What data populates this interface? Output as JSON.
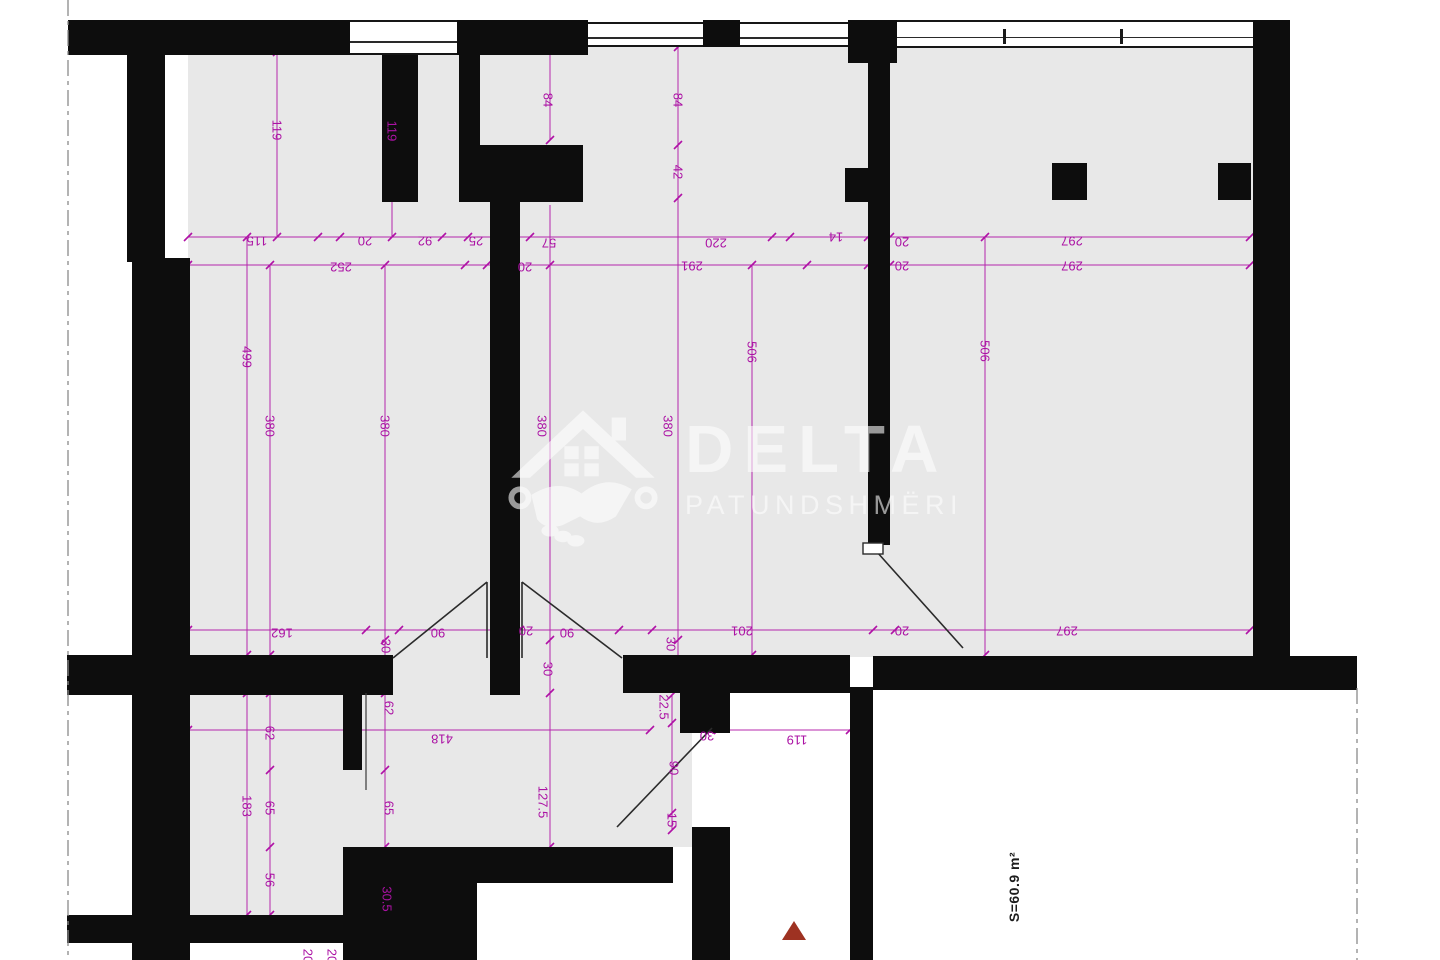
{
  "plan": {
    "watermark": {
      "brand": "DELTA",
      "subtitle": "PATUNDSHMËRI"
    },
    "area_label": "S=60.9 m²",
    "colors": {
      "dimension": "#ab12a4",
      "wall": "#0d0d0d",
      "floor": "#e8e8e8",
      "marker": "#9e3222",
      "boundary": "#8a8a8a"
    },
    "dimensions": [
      {
        "text": "115",
        "x": 257,
        "y": 241,
        "rot": 180
      },
      {
        "text": "20",
        "x": 365,
        "y": 241,
        "rot": 180
      },
      {
        "text": "92",
        "x": 425,
        "y": 241,
        "rot": 180
      },
      {
        "text": "25",
        "x": 476,
        "y": 241,
        "rot": 180
      },
      {
        "text": "57",
        "x": 549,
        "y": 243,
        "rot": 180
      },
      {
        "text": "220",
        "x": 716,
        "y": 243,
        "rot": 180
      },
      {
        "text": "14",
        "x": 836,
        "y": 237,
        "rot": 180
      },
      {
        "text": "20",
        "x": 902,
        "y": 242,
        "rot": 180
      },
      {
        "text": "297",
        "x": 1072,
        "y": 241,
        "rot": 180
      },
      {
        "text": "252",
        "x": 341,
        "y": 267,
        "rot": 180
      },
      {
        "text": "20",
        "x": 525,
        "y": 267,
        "rot": 180
      },
      {
        "text": "291",
        "x": 692,
        "y": 266,
        "rot": 180
      },
      {
        "text": "20",
        "x": 902,
        "y": 266,
        "rot": 180
      },
      {
        "text": "297",
        "x": 1072,
        "y": 266,
        "rot": 180
      },
      {
        "text": "119",
        "x": 277,
        "y": 130,
        "rot": 90
      },
      {
        "text": "119",
        "x": 392,
        "y": 131,
        "rot": 90
      },
      {
        "text": "84",
        "x": 548,
        "y": 100,
        "rot": 90
      },
      {
        "text": "84",
        "x": 678,
        "y": 100,
        "rot": 90
      },
      {
        "text": "42",
        "x": 678,
        "y": 172,
        "rot": 90
      },
      {
        "text": "499",
        "x": 247,
        "y": 357,
        "rot": 90
      },
      {
        "text": "380",
        "x": 270,
        "y": 426,
        "rot": 90
      },
      {
        "text": "380",
        "x": 385,
        "y": 426,
        "rot": 90
      },
      {
        "text": "380",
        "x": 542,
        "y": 426,
        "rot": 90
      },
      {
        "text": "380",
        "x": 668,
        "y": 426,
        "rot": 90
      },
      {
        "text": "506",
        "x": 752,
        "y": 352,
        "rot": 90
      },
      {
        "text": "506",
        "x": 985,
        "y": 351,
        "rot": 90
      },
      {
        "text": "162",
        "x": 282,
        "y": 633,
        "rot": 180
      },
      {
        "text": "30",
        "x": 386,
        "y": 646,
        "rot": 90
      },
      {
        "text": "90",
        "x": 438,
        "y": 633,
        "rot": 180
      },
      {
        "text": "20",
        "x": 526,
        "y": 631,
        "rot": 180
      },
      {
        "text": "90",
        "x": 567,
        "y": 633,
        "rot": 180
      },
      {
        "text": "30",
        "x": 548,
        "y": 669,
        "rot": 90
      },
      {
        "text": "30",
        "x": 671,
        "y": 644,
        "rot": 90
      },
      {
        "text": "201",
        "x": 742,
        "y": 631,
        "rot": 180
      },
      {
        "text": "20",
        "x": 902,
        "y": 631,
        "rot": 180
      },
      {
        "text": "297",
        "x": 1067,
        "y": 631,
        "rot": 180
      },
      {
        "text": "418",
        "x": 442,
        "y": 739,
        "rot": 180
      },
      {
        "text": "30",
        "x": 707,
        "y": 736,
        "rot": 180
      },
      {
        "text": "119",
        "x": 797,
        "y": 740,
        "rot": 180
      },
      {
        "text": "22.5",
        "x": 664,
        "y": 707,
        "rot": 90
      },
      {
        "text": "90",
        "x": 674,
        "y": 768,
        "rot": 90
      },
      {
        "text": "15",
        "x": 672,
        "y": 820,
        "rot": 90
      },
      {
        "text": "62",
        "x": 270,
        "y": 733,
        "rot": 90
      },
      {
        "text": "62",
        "x": 389,
        "y": 708,
        "rot": 90
      },
      {
        "text": "183",
        "x": 247,
        "y": 806,
        "rot": 90
      },
      {
        "text": "65",
        "x": 270,
        "y": 808,
        "rot": 90
      },
      {
        "text": "65",
        "x": 389,
        "y": 808,
        "rot": 90
      },
      {
        "text": "127.5",
        "x": 543,
        "y": 802,
        "rot": 90
      },
      {
        "text": "56",
        "x": 270,
        "y": 880,
        "rot": 90
      },
      {
        "text": "30.5",
        "x": 387,
        "y": 899,
        "rot": 90
      },
      {
        "text": "20",
        "x": 308,
        "y": 956,
        "rot": 90
      },
      {
        "text": "20",
        "x": 332,
        "y": 956,
        "rot": 90
      }
    ]
  }
}
